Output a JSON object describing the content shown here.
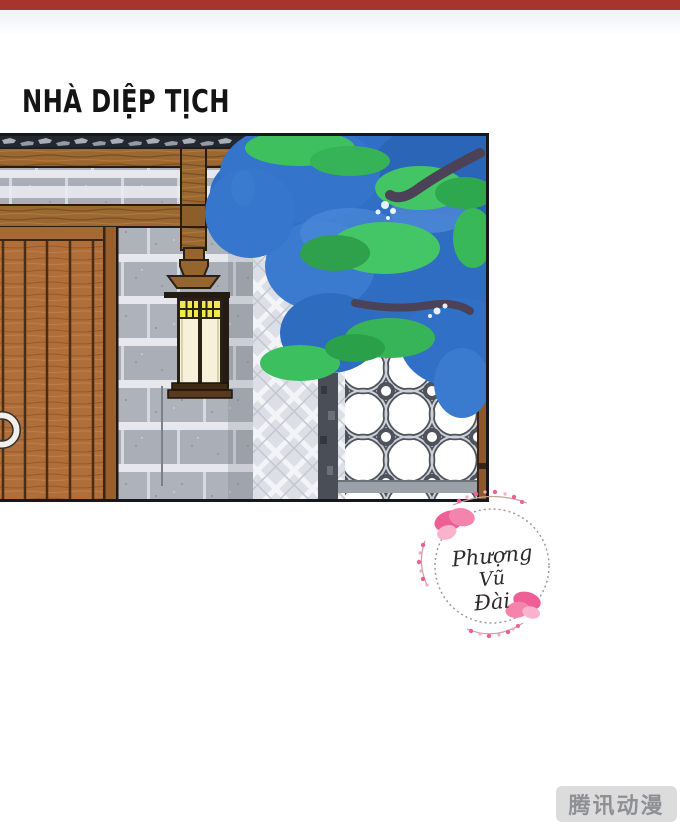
{
  "page": {
    "title": "NHÀ DIỆP TỊCH"
  },
  "top_bar": {
    "color": "#a8342e"
  },
  "panel": {
    "elements": [
      "roof-tiles",
      "wooden-beams",
      "stone-block-wall",
      "diamond-lattice-wall",
      "wooden-plank-door",
      "door-knocker-ring",
      "wall-lantern",
      "tree-foliage",
      "coin-lattice-fence",
      "fence-posts"
    ]
  },
  "watermark": {
    "line1": "Phượng",
    "line2": "Vũ",
    "line3": "Đài"
  },
  "badge": {
    "label": "腾讯动漫"
  },
  "colors": {
    "top_bar_red": "#a8342e",
    "tree_blue": "#2f6fc5",
    "leaf_green": "#3ec05e",
    "beam_brown": "#9b6831",
    "door_brown": "#b06f3a",
    "stone_gray": "#b1b6bf",
    "lantern_yellow": "#f1e84f",
    "lantern_cream": "#f6f1d8",
    "blossom_pink": "#ee5f95",
    "badge_bg": "#dcdcdd",
    "badge_text": "#8f9094"
  }
}
